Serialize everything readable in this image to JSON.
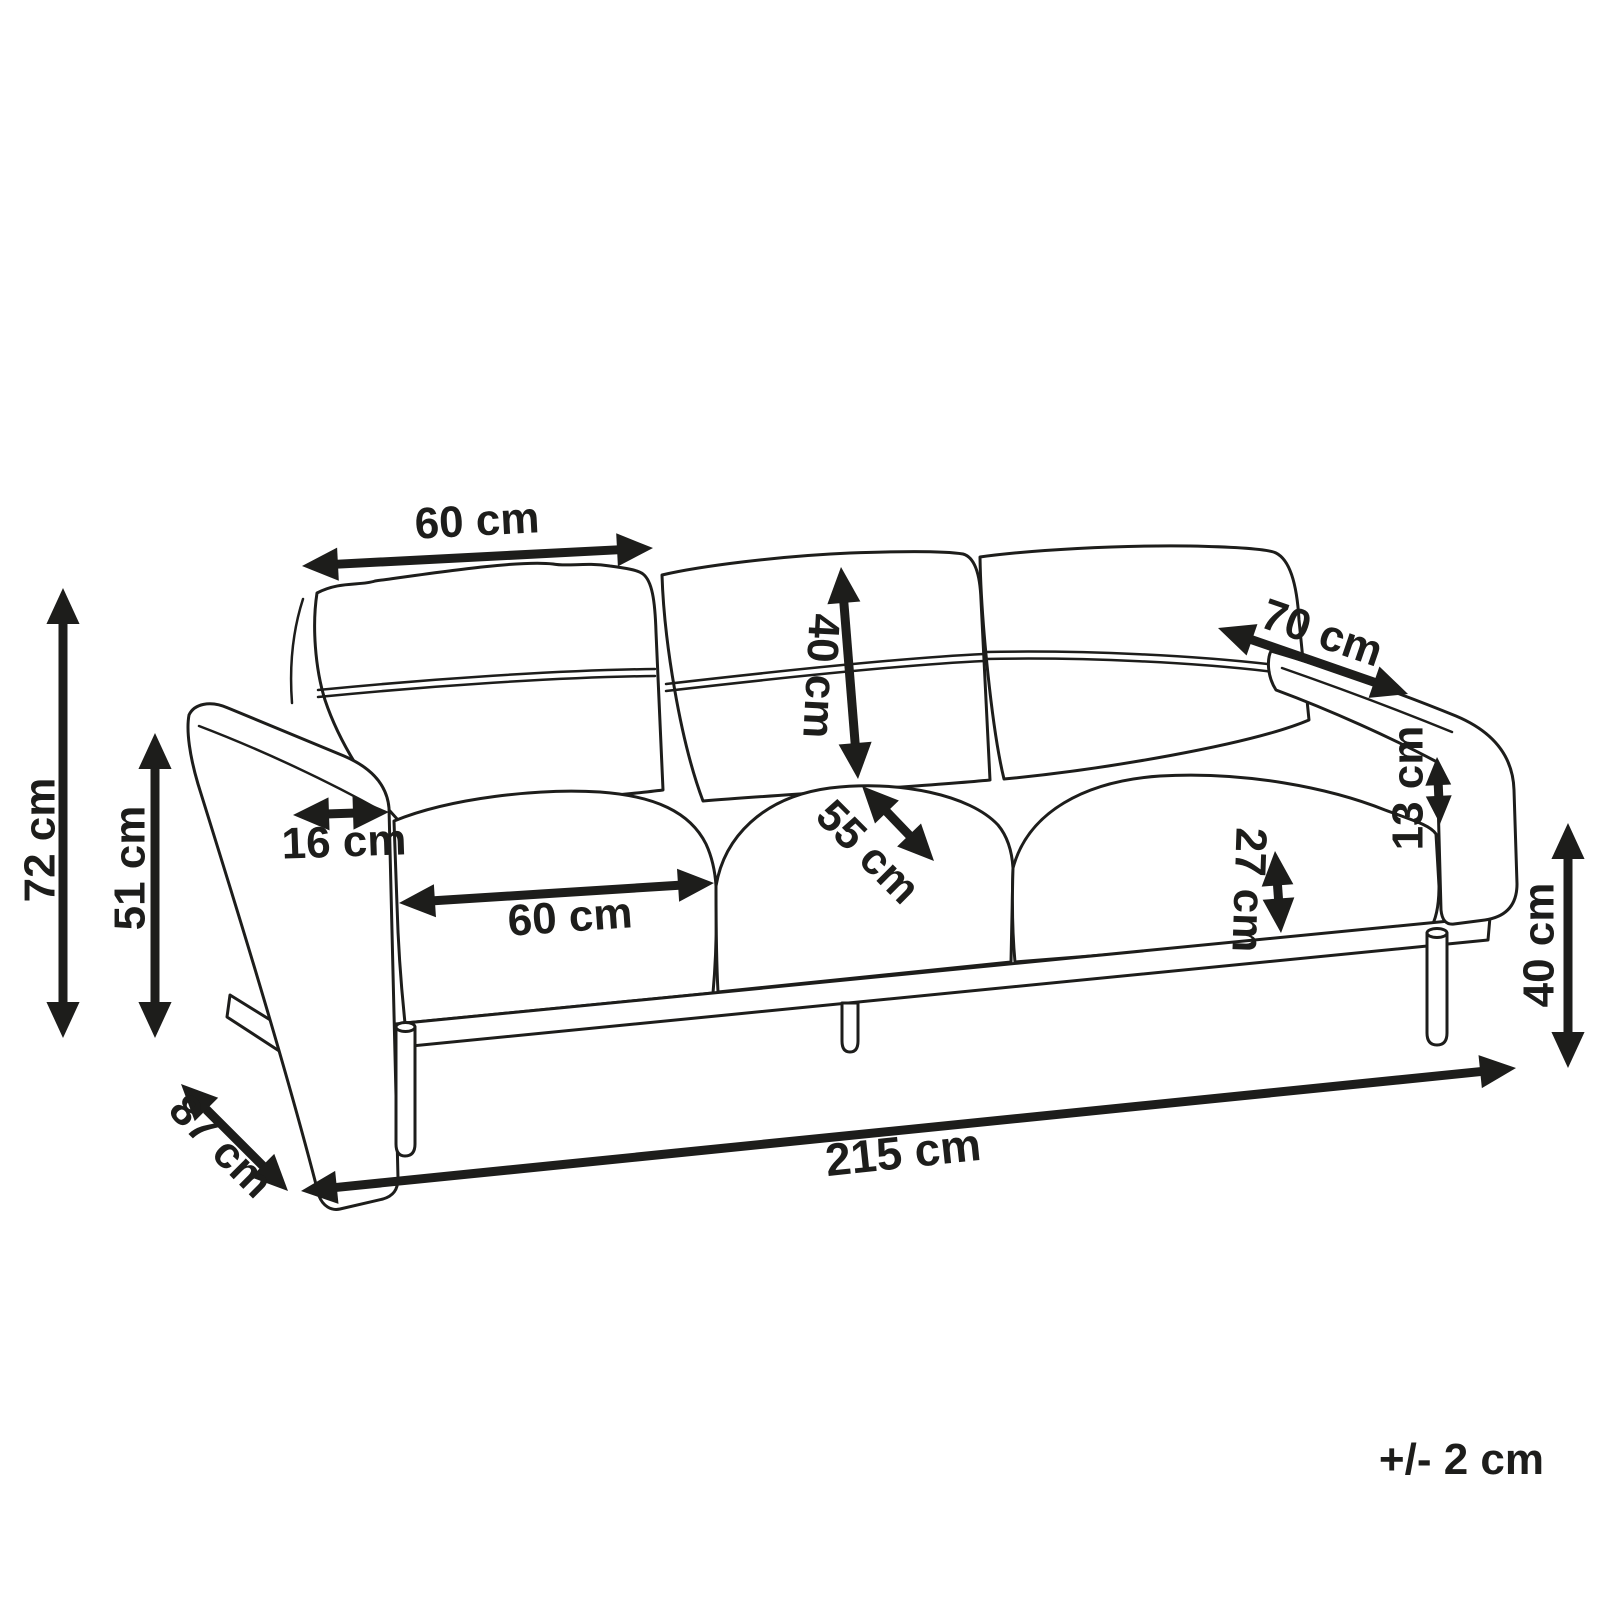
{
  "diagram": {
    "type": "furniture-dimension-diagram",
    "subject": "three-seat sofa line drawing, three-quarter front-left perspective view",
    "unit": "cm",
    "tolerance_note": "+/- 2 cm",
    "line_color": "#1d1d1b",
    "background_color": "#ffffff",
    "dimensions": [
      {
        "id": "backrest-cushion-width",
        "label": "60 cm",
        "value": 60,
        "measures": "width of one backrest cushion",
        "arrow": {
          "x1": 302,
          "y1": 566,
          "x2": 653,
          "y2": 548
        },
        "label_pos": {
          "x": 477,
          "y": 521,
          "rotate": -3
        }
      },
      {
        "id": "overall-height",
        "label": "72 cm",
        "value": 72,
        "measures": "total sofa height",
        "arrow": {
          "x1": 63,
          "y1": 588,
          "x2": 63,
          "y2": 1038
        },
        "label_pos": {
          "x": 40,
          "y": 840,
          "rotate": -90
        }
      },
      {
        "id": "armrest-height",
        "label": "51 cm",
        "value": 51,
        "measures": "armrest height from floor",
        "arrow": {
          "x1": 155,
          "y1": 733,
          "x2": 155,
          "y2": 1038
        },
        "label_pos": {
          "x": 130,
          "y": 868,
          "rotate": -90
        }
      },
      {
        "id": "armrest-width",
        "label": "16 cm",
        "value": 16,
        "measures": "armrest top width",
        "arrow": {
          "x1": 293,
          "y1": 815,
          "x2": 389,
          "y2": 812
        },
        "label_pos": {
          "x": 344,
          "y": 842,
          "rotate": -2
        }
      },
      {
        "id": "seat-cushion-width",
        "label": "60 cm",
        "value": 60,
        "measures": "width of one seat cushion",
        "arrow": {
          "x1": 399,
          "y1": 903,
          "x2": 714,
          "y2": 883
        },
        "label_pos": {
          "x": 570,
          "y": 917,
          "rotate": -4
        }
      },
      {
        "id": "backrest-cushion-height",
        "label": "40 cm",
        "value": 40,
        "measures": "backrest cushion height",
        "arrow": {
          "x1": 841,
          "y1": 567,
          "x2": 858,
          "y2": 779
        },
        "label_pos": {
          "x": 821,
          "y": 676,
          "rotate": 93
        }
      },
      {
        "id": "seat-depth",
        "label": "55 cm",
        "value": 55,
        "measures": "seat cushion depth",
        "arrow": {
          "x1": 862,
          "y1": 786,
          "x2": 934,
          "y2": 861
        },
        "label_pos": {
          "x": 868,
          "y": 852,
          "rotate": 45
        }
      },
      {
        "id": "armrest-depth",
        "label": "70 cm",
        "value": 70,
        "measures": "armrest depth front to back",
        "arrow": {
          "x1": 1218,
          "y1": 628,
          "x2": 1408,
          "y2": 694
        },
        "label_pos": {
          "x": 1322,
          "y": 633,
          "rotate": 19
        }
      },
      {
        "id": "armrest-gap-height",
        "label": "13 cm",
        "value": 13,
        "measures": "gap between seat cushion and armrest",
        "arrow": {
          "x1": 1437,
          "y1": 757,
          "x2": 1440,
          "y2": 824
        },
        "label_pos": {
          "x": 1408,
          "y": 788,
          "rotate": -90
        }
      },
      {
        "id": "seat-cushion-thickness",
        "label": "27 cm",
        "value": 27,
        "measures": "seat cushion thickness",
        "arrow": {
          "x1": 1275,
          "y1": 851,
          "x2": 1281,
          "y2": 933
        },
        "label_pos": {
          "x": 1249,
          "y": 890,
          "rotate": 92
        }
      },
      {
        "id": "leg-height",
        "label": "40 cm",
        "value": 40,
        "measures": "floor to seat frame height",
        "arrow": {
          "x1": 1568,
          "y1": 823,
          "x2": 1568,
          "y2": 1068
        },
        "label_pos": {
          "x": 1539,
          "y": 945,
          "rotate": -90
        }
      },
      {
        "id": "overall-width",
        "label": "215 cm",
        "value": 215,
        "measures": "total sofa width",
        "arrow": {
          "x1": 301,
          "y1": 1191,
          "x2": 1516,
          "y2": 1068
        },
        "label_pos": {
          "x": 903,
          "y": 1152,
          "rotate": -6,
          "size": 46
        }
      },
      {
        "id": "overall-depth",
        "label": "87 cm",
        "value": 87,
        "measures": "total sofa depth",
        "arrow": {
          "x1": 181,
          "y1": 1084,
          "x2": 288,
          "y2": 1191
        },
        "label_pos": {
          "x": 221,
          "y": 1146,
          "rotate": 45
        }
      }
    ]
  }
}
